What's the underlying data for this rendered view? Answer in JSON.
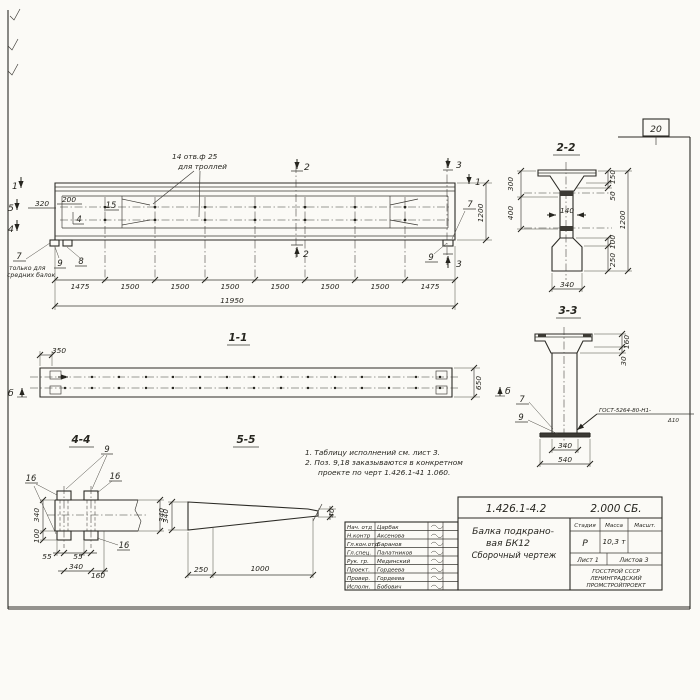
{
  "sheet": {
    "page_number": "20",
    "notes_line1": "1. Таблицу исполнений см. лист 3.",
    "notes_line2": "2. Поз. 9,18 заказываются в конкретном",
    "notes_line3": "проекте по черт 1.426.1-41 1.060."
  },
  "elevation": {
    "callout_line1": "14 отв.ф 25",
    "callout_line2": "для троллей",
    "mark_1_left": "1",
    "mark_5": "5",
    "mark_4": "4",
    "mark_2_top": "2",
    "mark_2_bottom": "2",
    "mark_3_top": "3",
    "mark_3_bottom": "3",
    "mark_1_right": "1",
    "dim_320": "320",
    "dim_200": "200",
    "dim_1200": "1200",
    "pos_15": "15",
    "pos_4": "4",
    "pos_7": "7",
    "pos_9": "9",
    "pos_8": "8",
    "pos_7_right": "7",
    "pos_9_right": "9",
    "note_line1": "только для",
    "note_line2": "средних балок",
    "dims_bottom": [
      "1475",
      "1500",
      "1500",
      "1500",
      "1500",
      "1500",
      "1500",
      "1475"
    ],
    "dim_total": "11950"
  },
  "section_1_1": {
    "title": "1-1",
    "dim_350": "350",
    "dim_650": "650",
    "mark_b_left": "б",
    "mark_b_right": "б"
  },
  "section_2_2": {
    "title": "2-2",
    "dim_300": "300",
    "dim_400": "400",
    "dim_150": "150",
    "dim_50": "50",
    "dim_100": "100",
    "dim_250": "250",
    "dim_1200": "1200",
    "dim_140": "140",
    "dim_340": "340"
  },
  "section_3_3": {
    "title": "3-3",
    "dim_160": "160",
    "dim_30": "30",
    "dim_340": "340",
    "dim_540": "540",
    "pos_7": "7",
    "pos_9": "9",
    "weld_note_line1": "ГОСТ-5264-80-Н1-",
    "weld_note_line2": "Δ10"
  },
  "section_4_4": {
    "title": "4-4",
    "pos_9": "9",
    "pos_16_a": "16",
    "pos_16_b": "16",
    "pos_16_c": "16",
    "dim_340_left": "340",
    "dim_100": "100",
    "dim_55_a": "55",
    "dim_55_b": "55",
    "dim_340_bottom": "340",
    "dim_160": "160",
    "dim_340_right": "340"
  },
  "section_5_5": {
    "title": "5-5",
    "dim_340": "340",
    "dim_40": "40",
    "dim_250": "250",
    "dim_1000": "1000"
  },
  "title_block": {
    "doc_number": "1.426.1-4.2",
    "doc_code": "2.000 СБ.",
    "title_line1": "Балка подкрано-",
    "title_line2": "вая БК12",
    "title_line3": "Сборочный чертеж",
    "stage_label": "Стадия",
    "mass_label": "Масса",
    "scale_label": "Масшт.",
    "stage_value": "Р",
    "mass_value": "10,3 т",
    "sheet_label": "Лист 1",
    "sheets_label": "Листов 3",
    "org_line1": "ГОССТРОЙ СССР",
    "org_line2": "ЛЕНИНГРАДСКИЙ",
    "org_line3": "ПРОМСТРОЙПРОЕКТ",
    "signatures": [
      {
        "role": "Нач. отд",
        "name": "Царбак"
      },
      {
        "role": "Н.контр",
        "name": "Аксенова"
      },
      {
        "role": "Гл.кон.отд",
        "name": "Баранов"
      },
      {
        "role": "Гл.спец.",
        "name": "Палатников"
      },
      {
        "role": "Рук. гр.",
        "name": "Мединский"
      },
      {
        "role": "Проект.",
        "name": "Гордеева"
      },
      {
        "role": "Провер.",
        "name": "Гордеева"
      },
      {
        "role": "Исполн.",
        "name": "Бобович"
      }
    ]
  }
}
